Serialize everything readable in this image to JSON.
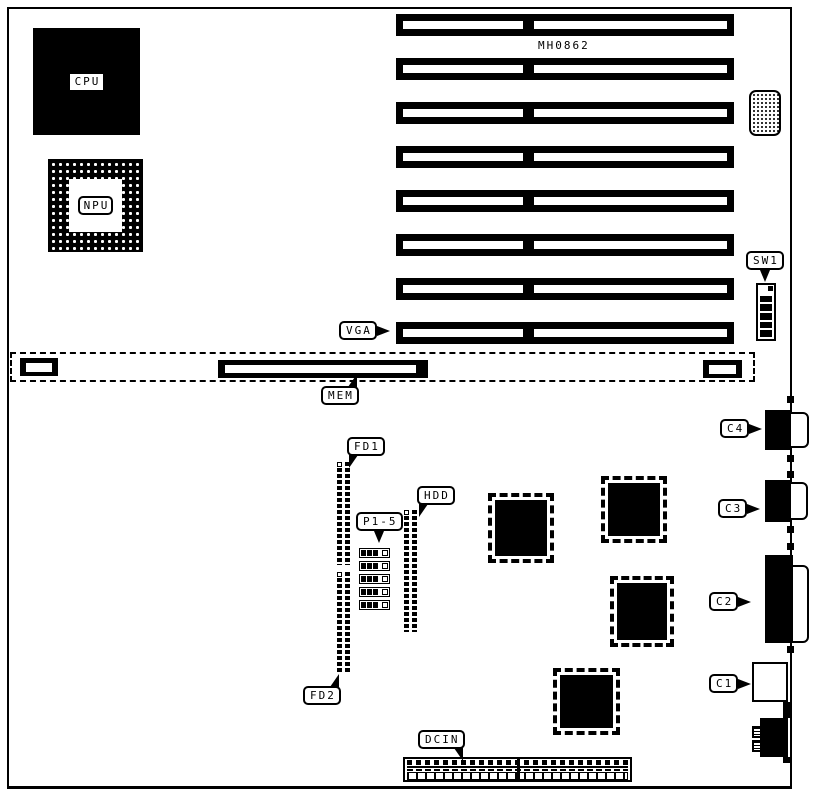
{
  "board": {
    "model_text": "MH0862",
    "labels": {
      "cpu": "CPU",
      "npu": "NPU",
      "vga": "VGA",
      "mem": "MEM",
      "sw1": "SW1",
      "fd1": "FD1",
      "fd2": "FD2",
      "p1_5": "P1-5",
      "hdd": "HDD",
      "dcin": "DCIN",
      "c1": "C1",
      "c2": "C2",
      "c3": "C3",
      "c4": "C4"
    },
    "colors": {
      "ink": "#000000",
      "paper": "#ffffff"
    },
    "structure": {
      "expansion_slots": 8,
      "dip_switch_positions": 6,
      "jumpers": 5,
      "edge_dots": 6
    }
  }
}
